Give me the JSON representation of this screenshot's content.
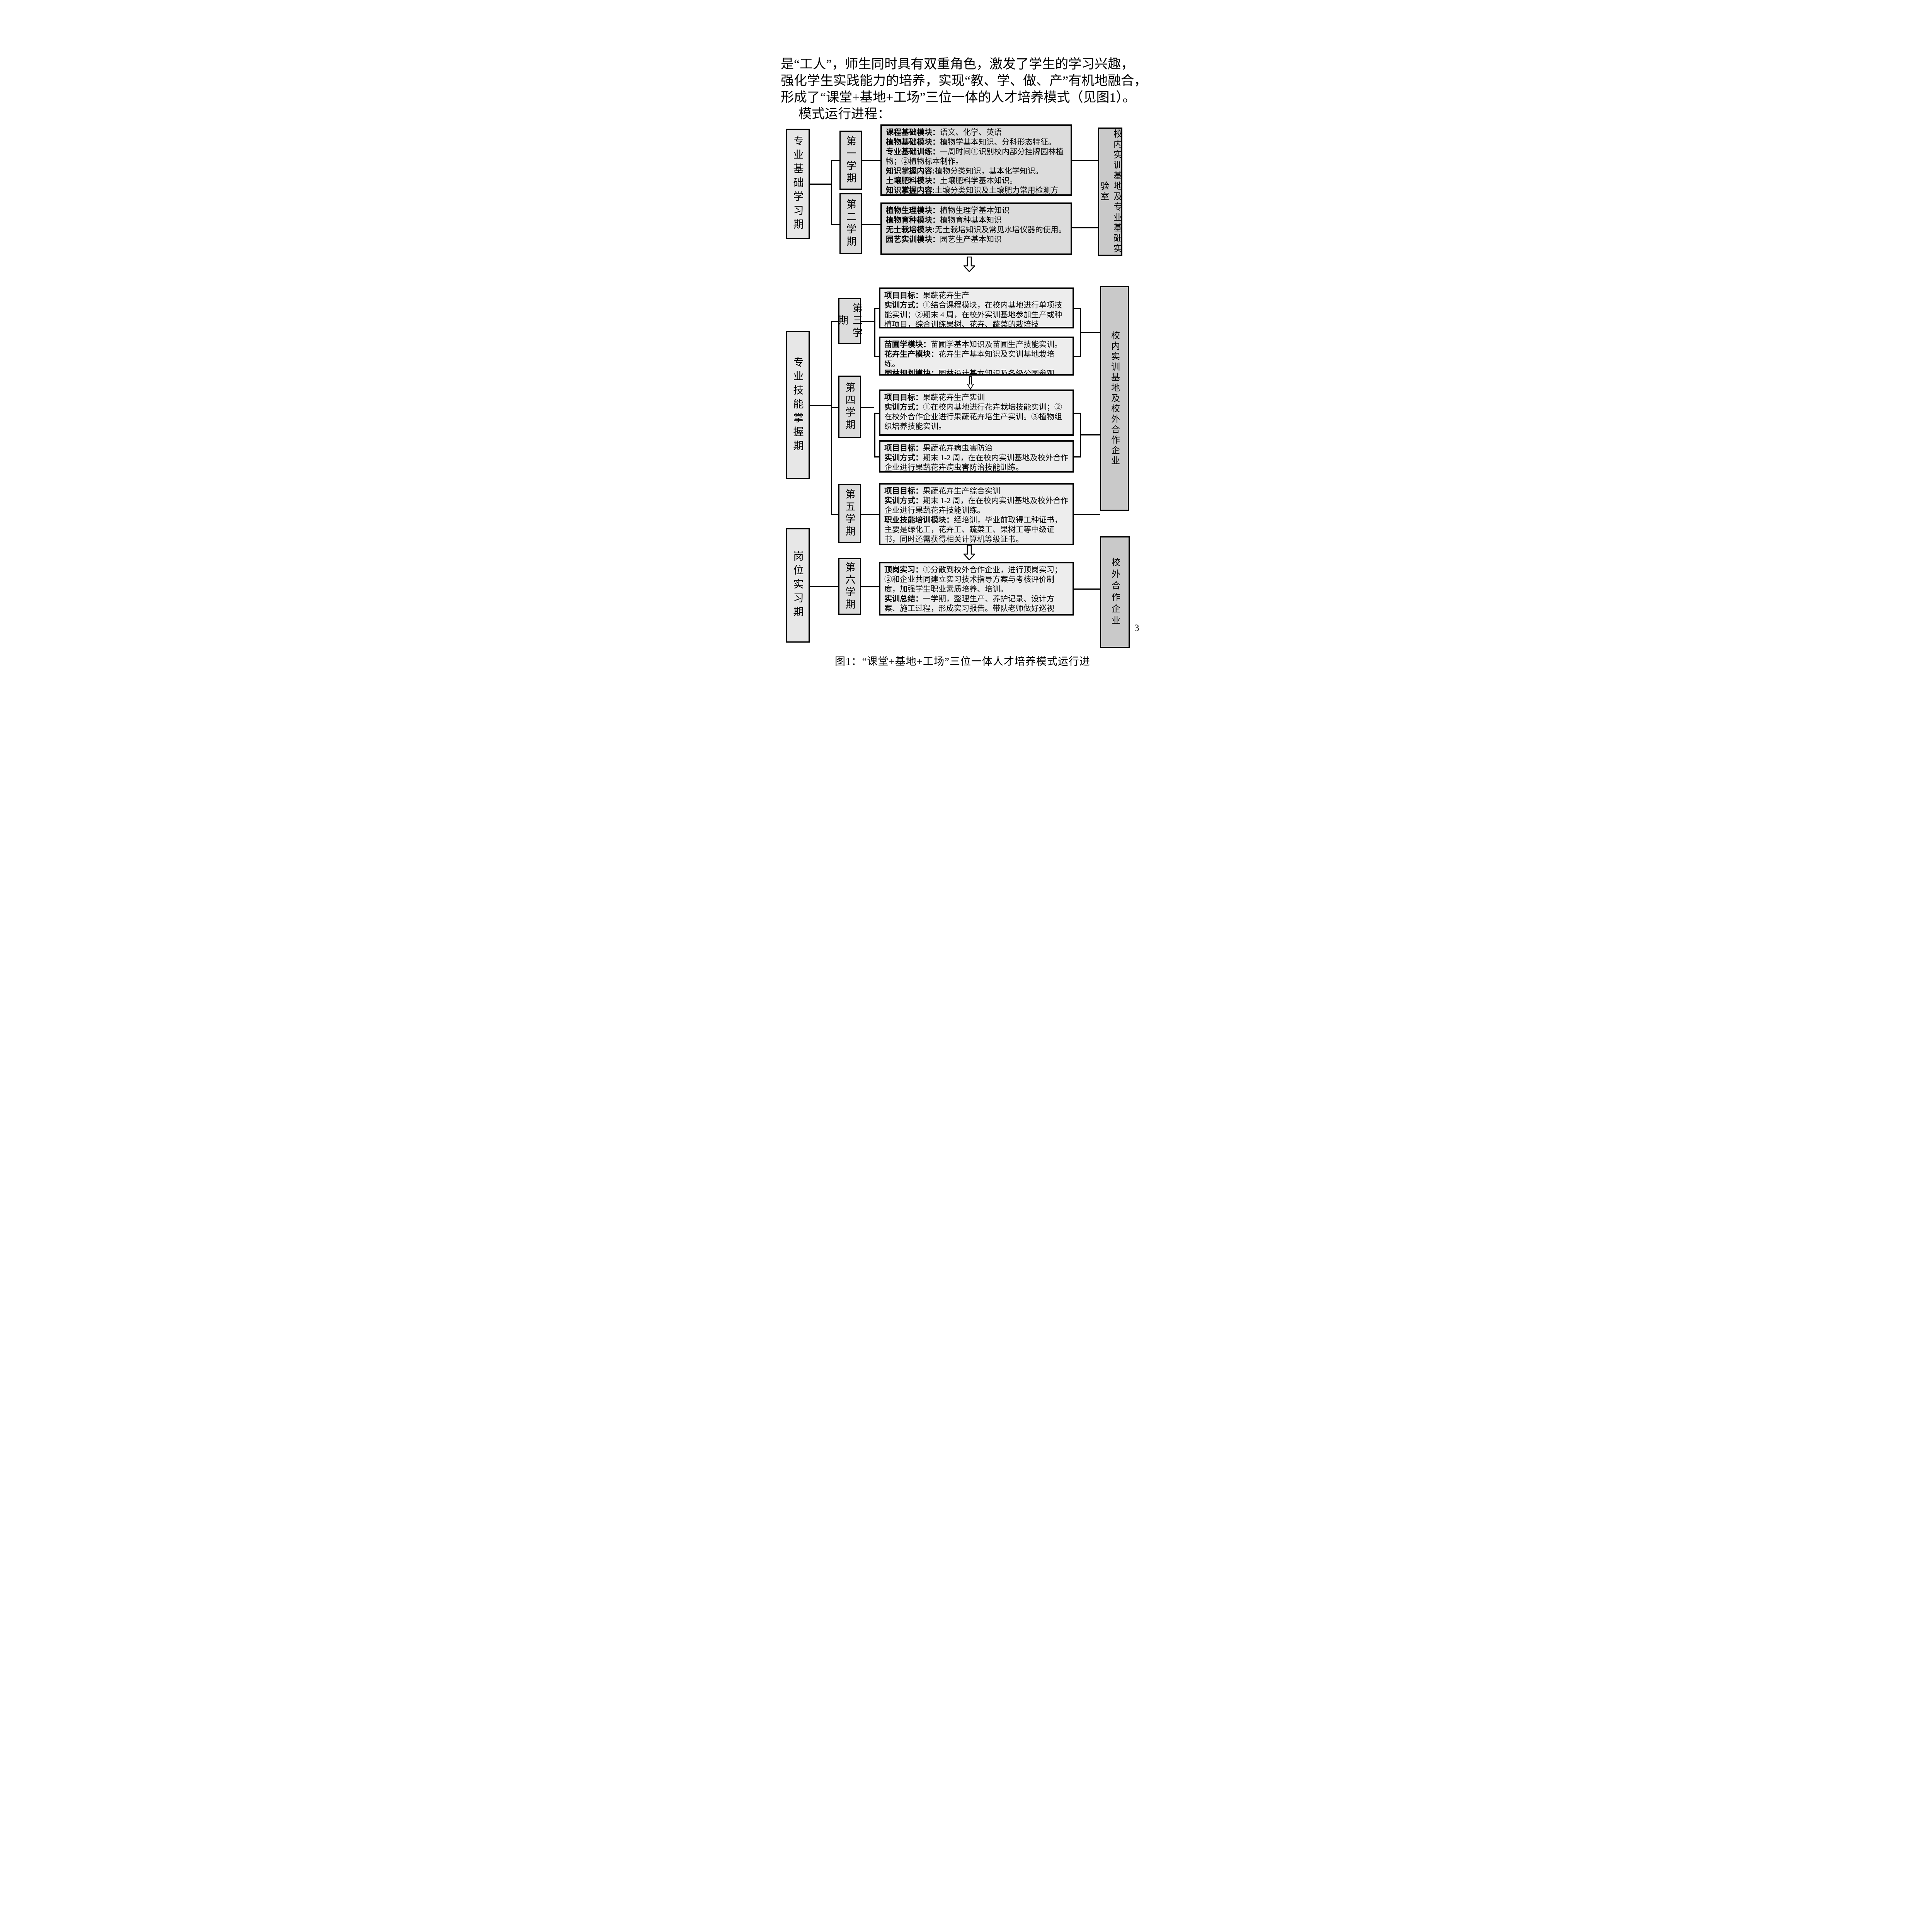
{
  "page": {
    "paragraph_lines": [
      "是“工人”，师生同时具有双重角色，激发了学生的学习兴趣，",
      "强化学生实践能力的培养，实现“教、学、做、产”有机地融合，",
      "形成了“课堂+基地+工场”三位一体的人才培养模式（见图1）。",
      "模式运行进程："
    ],
    "caption": "图1：“课堂+基地+工场”三位一体人才培养模式运行进",
    "page_number": "3"
  },
  "flow": {
    "periods": [
      "专业基础学习期",
      "专业技能掌握期",
      "岗位实习期"
    ],
    "semesters": [
      "第一学期",
      "第二学期",
      "第三学期",
      "第四学期",
      "第五学期",
      "第六学期"
    ],
    "bases": [
      "校内实训基地及专业基础实验室",
      "校内实训基地及校外合作企业",
      "校外合作企业"
    ],
    "boxes": {
      "c1": {
        "entries": [
          {
            "label": "课程基础模块：",
            "text": "语文、化学、英语"
          },
          {
            "label": "植物基础模块：",
            "text": "植物学基本知识、分科形态特征。"
          },
          {
            "label": "专业基础训练：",
            "text": "一周时间①识别校内部分挂牌园林植物；②植物标本制作。"
          },
          {
            "label": "知识掌握内容:",
            "text": "植物分类知识，基本化学知识。"
          },
          {
            "label": "土壤肥料模块：",
            "text": "土壤肥料学基本知识。"
          },
          {
            "label": "知识掌握内容:",
            "text": "土壤分类知识及土壤肥力常用检测方法，植物几种生理指标的检测。"
          }
        ]
      },
      "c2": {
        "entries": [
          {
            "label": "植物生理模块：",
            "text": "植物生理学基本知识"
          },
          {
            "label": "植物育种模块：",
            "text": "植物育种基本知识"
          },
          {
            "label": "无土栽培模块:",
            "text": "无土栽培知识及常见水培仪器的使用。"
          },
          {
            "label": "园艺实训模块：",
            "text": "园艺生产基本知识"
          }
        ]
      },
      "c3": {
        "entries": [
          {
            "label": "项目目标：",
            "text": "果蔬花卉生产"
          },
          {
            "label": "实训方式：",
            "text": "①结合课程模块，在校内基地进行单项技能实训；②期末 4 周，在校外实训基地参加生产或种植项目，综合训练果树、花卉、蔬菜的栽培技"
          }
        ]
      },
      "c4": {
        "entries": [
          {
            "label": "苗圃学模块：",
            "text": "苗圃学基本知识及苗圃生产技能实训。"
          },
          {
            "label": "花卉生产模块：",
            "text": "花卉生产基本知识及实训基地栽培练。"
          },
          {
            "label": "园林规划模块：",
            "text": "园林设计基本知识及各级公园参观。"
          }
        ]
      },
      "c5": {
        "entries": [
          {
            "label": "项目目标：",
            "text": "果蔬花卉生产实训"
          },
          {
            "label": "实训方式：",
            "text": "①在校内基地进行花卉栽培技能实训；②在校外合作企业进行果蔬花卉培生产实训。③植物组织培养技能实训。"
          }
        ]
      },
      "c6": {
        "entries": [
          {
            "label": "项目目标：",
            "text": "果蔬花卉病虫害防治"
          },
          {
            "label": "实训方式：",
            "text": "期末 1-2 周，在在校内实训基地及校外合作企业进行果蔬花卉病虫害防治技能训练。"
          }
        ]
      },
      "c7": {
        "entries": [
          {
            "label": "项目目标：",
            "text": "果蔬花卉生产综合实训"
          },
          {
            "label": "实训方式：",
            "text": "期末 1-2 周，在在校内实训基地及校外合作企业进行果蔬花卉技能训练。"
          },
          {
            "label": "职业技能培训模块：",
            "text": "经培训，毕业前取得工种证书，主要是绿化工，花卉工、蔬菜工、果树工等中级证书，同时还需获得相关计算机等级证书。"
          }
        ]
      },
      "c8": {
        "entries": [
          {
            "label": "顶岗实习：",
            "text": "①分散到校外合作企业，进行顶岗实习；②和企业共同建立实习技术指导方案与考核评价制度，加强学生职业素质培养、培训。"
          },
          {
            "label": "实训总结：",
            "text": "一学期，整理生产、养护记录、设计方案、施工过程，形成实习报告。带队老师做好巡视"
          }
        ]
      }
    }
  }
}
